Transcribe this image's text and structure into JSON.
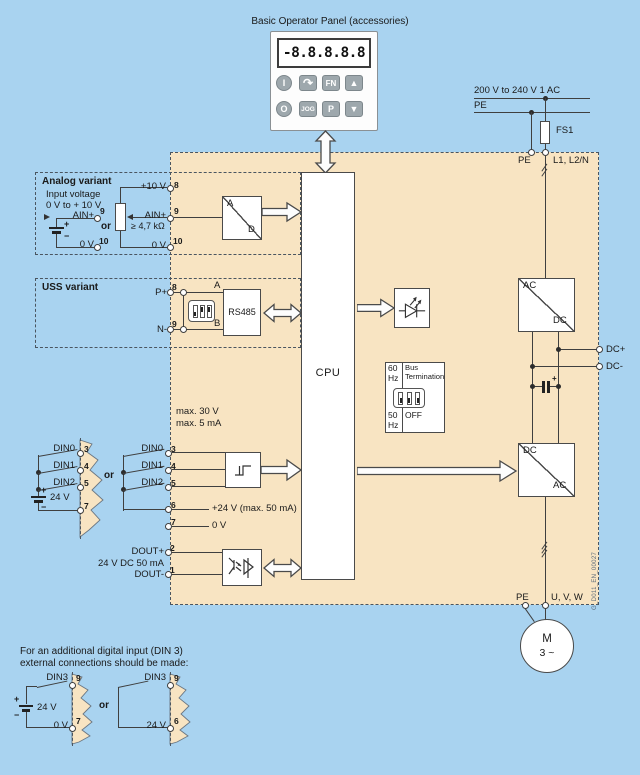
{
  "colors": {
    "background": "#A9D3F0",
    "panel": "#F8E4C2",
    "wire": "#3F3F3F",
    "border": "#4A5560",
    "button": "#9EA8AD"
  },
  "bop": {
    "title": "Basic Operator Panel (accessories)",
    "display": "-8.8.8.8.8",
    "buttons": {
      "on": "I",
      "reverse": "↷",
      "fn": "FN",
      "up": "▲",
      "off": "O",
      "jog": "JOG",
      "p": "P",
      "down": "▼"
    }
  },
  "mains": {
    "supply": "200 V to 240 V  1 AC",
    "pe": "PE",
    "fuse": "FS1",
    "term_pe": "PE",
    "term_line": "L1, L2/N"
  },
  "analog": {
    "title": "Analog variant",
    "input_line1": "Input voltage",
    "input_line2": "0 V to + 10 V",
    "ext_ain": "AIN+",
    "ext_ain_pin": "9",
    "ext_zero": "0 V",
    "ext_zero_pin": "10",
    "or": "or",
    "plus": "+",
    "minus": "−",
    "p10": "+10 V",
    "p10_pin": "8",
    "ain": "AIN+",
    "ain_pin": "9",
    "resistor": "≥ 4,7 kΩ",
    "zero": "0 V",
    "zero_pin": "10",
    "adc_a": "A",
    "adc_d": "D"
  },
  "uss": {
    "title": "USS variant",
    "p": "P+",
    "p_pin": "8",
    "n": "N-",
    "n_pin": "9",
    "a": "A",
    "b": "B",
    "rs485": "RS485"
  },
  "cpu": "CPU",
  "bus_term": {
    "hz60": "60\nHz",
    "title": "Bus\nTermination",
    "hz50": "50\nHz",
    "off": "OFF"
  },
  "din": {
    "max_v": "max. 30 V",
    "max_i": "max. 5 mA",
    "or": "or",
    "plus": "+",
    "minus": "−",
    "battery": "24 V",
    "common_pin": "7",
    "inputs": [
      {
        "label": "DIN0",
        "pin": "3"
      },
      {
        "label": "DIN1",
        "pin": "4"
      },
      {
        "label": "DIN2",
        "pin": "5"
      }
    ]
  },
  "supply_out": {
    "p24": "+24 V (max. 50 mA)",
    "p24_pin": "6",
    "zero": "0 V",
    "zero_pin": "7"
  },
  "dout": {
    "plus": "DOUT+",
    "plus_pin": "2",
    "rating": "24 V DC 50 mA",
    "minus": "DOUT-",
    "minus_pin": "1"
  },
  "rectifier": {
    "in": "AC",
    "out": "DC"
  },
  "dc_link": {
    "plus": "DC+",
    "minus": "DC-",
    "cap_plus": "+"
  },
  "inverter": {
    "in": "DC",
    "out": "AC"
  },
  "output": {
    "pe": "PE",
    "uvw": "U, V, W"
  },
  "motor": {
    "m": "M",
    "phases": "3 ~"
  },
  "watermark": "G_D011_EN_00027",
  "din3": {
    "note1": "For an additional digital input (DIN 3)",
    "note2": "external connections should be made:",
    "or": "or",
    "left": {
      "label": "DIN3",
      "pin": "9",
      "plus": "+",
      "battery": "24 V",
      "minus": "−",
      "zero": "0 V",
      "zero_pin": "7"
    },
    "right": {
      "label": "DIN3",
      "pin": "9",
      "battery": "24 V",
      "battery_pin": "6"
    }
  }
}
